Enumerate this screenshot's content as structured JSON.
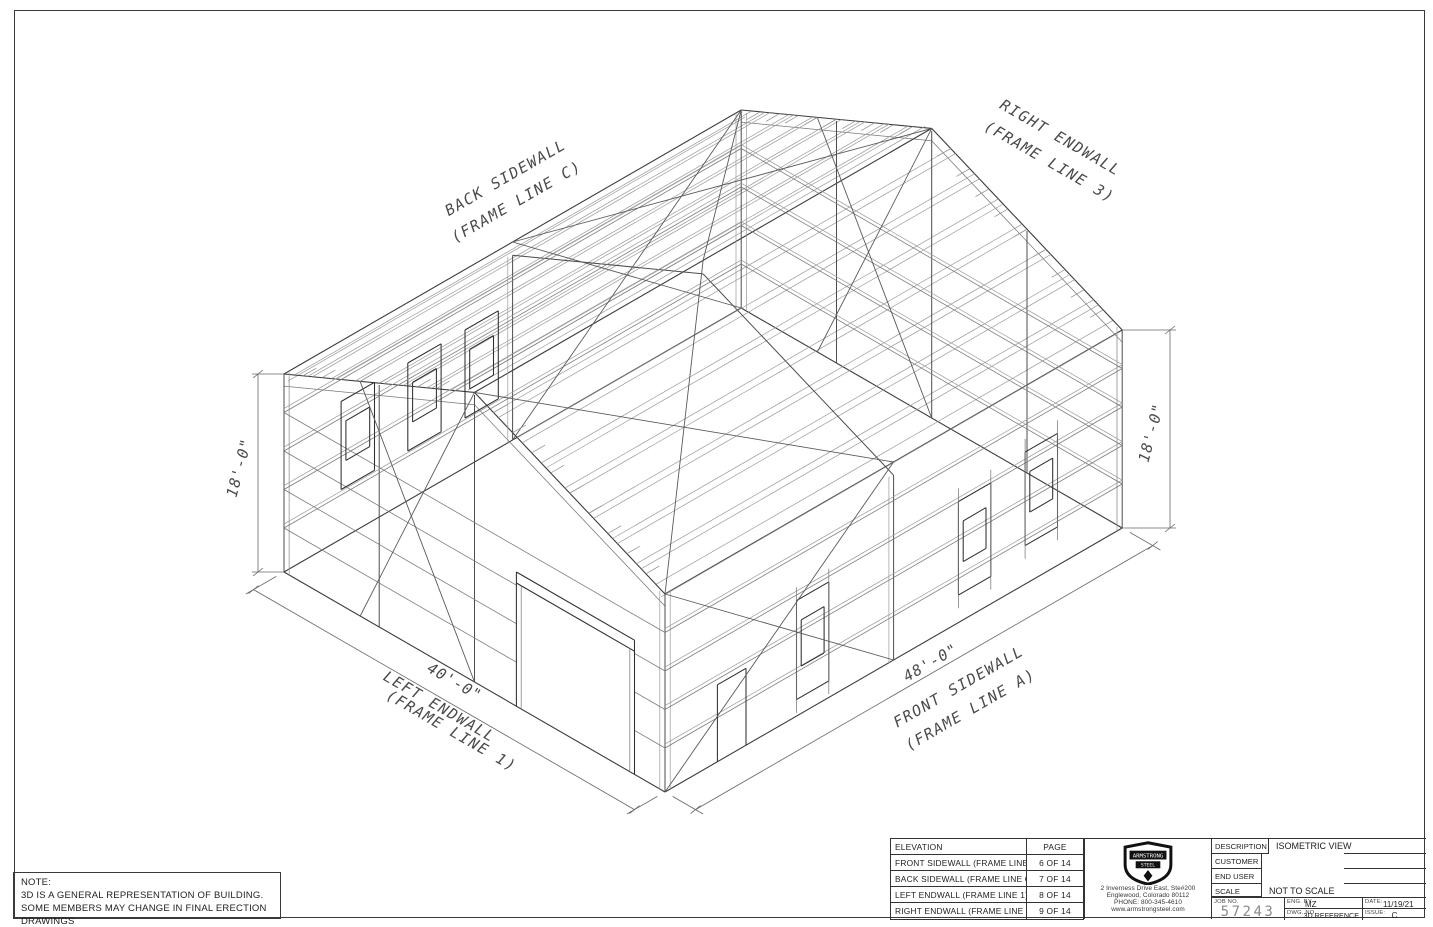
{
  "drawing": {
    "back_sidewall": {
      "line1": "BACK SIDEWALL",
      "line2": "(FRAME LINE C)"
    },
    "right_endwall": {
      "line1": "RIGHT ENDWALL",
      "line2": "(FRAME LINE 3)"
    },
    "left_endwall": {
      "line1": "LEFT ENDWALL",
      "line2": "(FRAME LINE 1)"
    },
    "front_sidewall": {
      "line1": "FRONT SIDEWALL",
      "line2": "(FRAME LINE A)"
    },
    "dim_height_left": "18'-0\"",
    "dim_height_right": "18'-0\"",
    "dim_endwall_width": "40'-0\"",
    "dim_sidewall_length": "48'-0\""
  },
  "note": {
    "title": "NOTE:",
    "line1": "3D IS A GENERAL REPRESENTATION OF BUILDING.",
    "line2": "SOME MEMBERS MAY CHANGE IN FINAL ERECTION DRAWINGS"
  },
  "elevation_table": {
    "headers": [
      "ELEVATION",
      "PAGE"
    ],
    "rows": [
      [
        "FRONT SIDEWALL (FRAME LINE A)",
        "6 OF 14"
      ],
      [
        "BACK SIDEWALL (FRAME LINE C)",
        "7 OF 14"
      ],
      [
        "LEFT ENDWALL (FRAME LINE 1)",
        "8 OF 14"
      ],
      [
        "RIGHT ENDWALL (FRAME LINE 3)",
        "9 OF 14"
      ]
    ]
  },
  "company": {
    "name_top": "ARMSTRONG",
    "name_bottom": "STEEL",
    "address1": "2 Inverness Drive East, Ste#200",
    "address2": "Englewood, Colorado 80112",
    "phone": "PHONE: 800-345-4610",
    "web": "www.armstrongsteel.com"
  },
  "title_block": {
    "description_label": "DESCRIPTION",
    "description": "ISOMETRIC VIEW",
    "customer_label": "CUSTOMER",
    "end_user_label": "END USER",
    "scale_label": "SCALE",
    "scale": "NOT TO SCALE",
    "job_no_label": "JOB NO.",
    "job_no": "57243",
    "eng_by_label": "ENG. BY.",
    "eng_by": "MZ",
    "dwg_no_label": "DWG. NO.",
    "dwg_no": "3D REFERENCE",
    "date_label": "DATE:",
    "date": "11/19/21",
    "issue_label": "ISSUE:",
    "issue": "C"
  },
  "colors": {
    "line": "#3b3b3b",
    "light_line": "#9a9a9a",
    "paper": "#ffffff"
  }
}
